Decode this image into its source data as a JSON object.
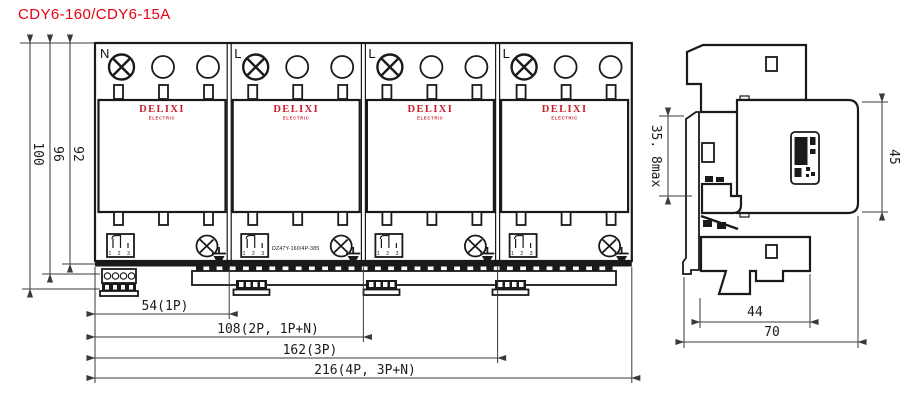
{
  "title": "CDY6-160/CDY6-15A",
  "colors": {
    "title_red": "#e60012",
    "brand_red": "#c8202c",
    "line": "#1a1a1a",
    "dim": "#3a3a3a"
  },
  "front_view": {
    "modules": [
      {
        "terminal_label": "N"
      },
      {
        "terminal_label": "L",
        "model_text": "DZ47Y-160/4P-385"
      },
      {
        "terminal_label": "L"
      },
      {
        "terminal_label": "L"
      }
    ],
    "brand": {
      "name": "DELIXI",
      "subtitle": "ELECTRIC"
    },
    "terminal_numbers": "1 2 3",
    "dimensions": {
      "height_outer": "100",
      "height_mid": "96",
      "height_body": "92",
      "width_1p": "54(1P)",
      "width_2p": "108(2P, 1P+N)",
      "width_3p": "162(3P)",
      "width_4p": "216(4P, 3P+N)"
    }
  },
  "side_view": {
    "dimensions": {
      "depth_max": "35. 8max",
      "body_height": "45",
      "width_inner": "44",
      "width_total": "70"
    }
  }
}
